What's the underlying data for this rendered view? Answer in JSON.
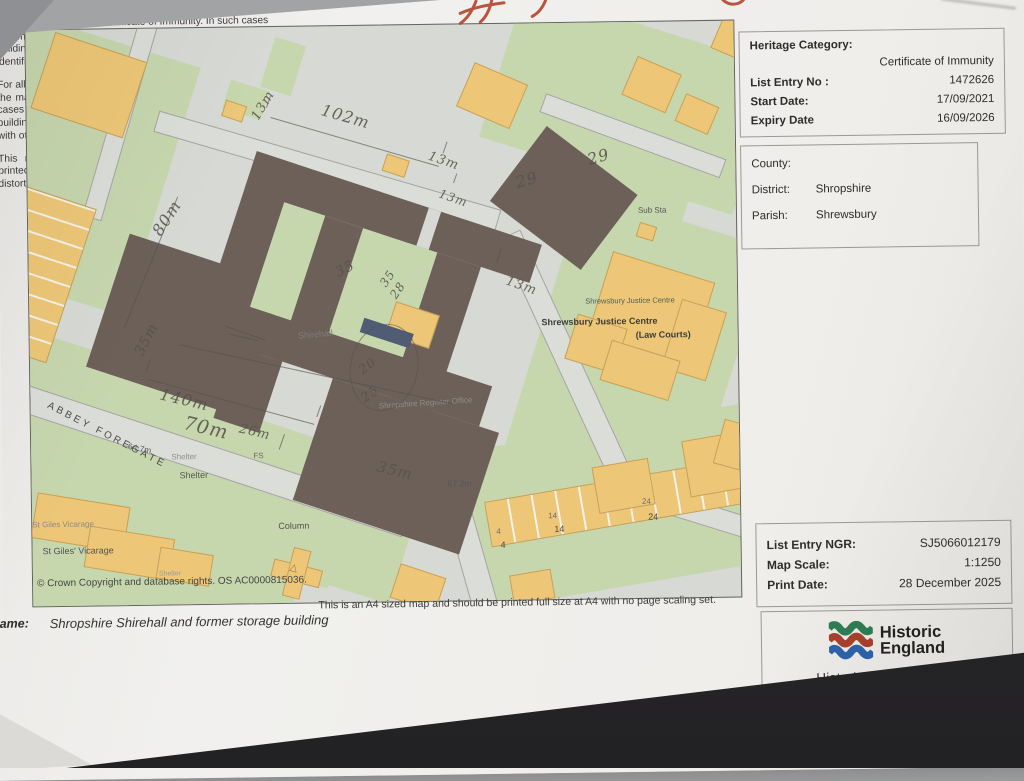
{
  "panel": {
    "heritage": {
      "title": "Heritage Category:",
      "category": "Certificate of Immunity",
      "rows": [
        {
          "label": "List Entry No :",
          "value": "1472626"
        },
        {
          "label": "Start Date:",
          "value": "17/09/2021"
        },
        {
          "label": "Expiry Date",
          "value": "16/09/2026"
        }
      ]
    },
    "location": {
      "rows": [
        {
          "label": "County:",
          "value": ""
        },
        {
          "label": "District:",
          "value": "Shropshire"
        },
        {
          "label": "Parish:",
          "value": "Shrewsbury"
        }
      ]
    },
    "paragraphs": [
      "For all Certificates of Immunity pre-dating 4 April 2011 maps do not form part of the Certificate of Immunity. In such cases the map here is generated from the description of the building within the Certificate and added later to aid identification of the principal listed building or buildings.",
      "For all Certificates of Immunity made on or after 4 April 2011 the map here does form part of the official record. In such cases the map is to aid identification of the principal listed building or buildings only and must be read in conjunction with other information in the record.",
      "This map has been delivered electronically and when printed may not be to scale and may be subject to distortions."
    ],
    "print_info": {
      "rows": [
        {
          "label": "List Entry NGR:",
          "value": "SJ5066012179"
        },
        {
          "label": "Map Scale:",
          "value": "1:1250"
        },
        {
          "label": "Print Date:",
          "value": "28 December 2025"
        }
      ]
    },
    "logo": {
      "line1": "Historic",
      "line2": "England",
      "url": "HistoricEngland.org.uk"
    }
  },
  "footer": {
    "print_note": "This is an A4 sized map and should be printed full size at A4 with no page scaling set.",
    "name_label": "Name:",
    "name_value": "Shropshire Shirehall and former storage building"
  },
  "map": {
    "copyright": "© Crown Copyright and database rights. OS AC0000815036.",
    "labels": [
      {
        "t": "ABBEY FOREGATE",
        "x": 20,
        "y": 370,
        "r": 28,
        "fs": 10,
        "c": "#4c4c4a",
        "ls": 3
      },
      {
        "t": "64.7m",
        "x": 98,
        "y": 412,
        "r": 12,
        "fs": 8.5,
        "c": "#5a5a58"
      },
      {
        "t": "Shelter",
        "x": 140,
        "y": 424,
        "r": 0,
        "fs": 8,
        "c": "#90908e"
      },
      {
        "t": "Shelter",
        "x": 148,
        "y": 442,
        "r": 0,
        "fs": 9,
        "c": "#575755"
      },
      {
        "t": "Shelter",
        "x": 126,
        "y": 542,
        "r": 0,
        "fs": 7,
        "c": "#9a9a98"
      },
      {
        "t": "St Giles Vicarage",
        "x": 0,
        "y": 490,
        "r": 0,
        "fs": 8,
        "c": "#8a8a88"
      },
      {
        "t": "St Giles' Vicarage",
        "x": 10,
        "y": 516,
        "r": 0,
        "fs": 9,
        "c": "#525250"
      },
      {
        "t": "Column",
        "x": 246,
        "y": 494,
        "r": 0,
        "fs": 9,
        "c": "#525250"
      },
      {
        "t": "FS",
        "x": 222,
        "y": 424,
        "r": 0,
        "fs": 8,
        "c": "#6a6a68"
      },
      {
        "t": "Sub Sta",
        "x": 610,
        "y": 184,
        "r": 0,
        "fs": 8,
        "c": "#565654"
      },
      {
        "t": "Shrewsbury Justice Centre",
        "x": 556,
        "y": 274,
        "r": 0,
        "fs": 7.5,
        "c": "#4e5e52"
      },
      {
        "t": "Shrewsbury Justice Centre",
        "x": 512,
        "y": 294,
        "r": 0,
        "fs": 9,
        "c": "#3c3c3a",
        "w": 600
      },
      {
        "t": "(Law Courts)",
        "x": 606,
        "y": 308,
        "r": 0,
        "fs": 9,
        "c": "#3c3c3a",
        "w": 600
      },
      {
        "t": "Shirehall",
        "x": 268,
        "y": 304,
        "r": -4,
        "fs": 9,
        "c": "#7e7e78"
      },
      {
        "t": "Shropshire Register Office",
        "x": 348,
        "y": 376,
        "r": -3,
        "fs": 8,
        "c": "#8e8e86"
      },
      {
        "t": "67.2m",
        "x": 416,
        "y": 454,
        "r": 0,
        "fs": 8.5,
        "c": "#565654"
      },
      {
        "t": "4",
        "x": 464,
        "y": 503,
        "r": 0,
        "fs": 8,
        "c": "#6e6e6c"
      },
      {
        "t": "14",
        "x": 516,
        "y": 488,
        "r": 0,
        "fs": 8,
        "c": "#6e6e6c"
      },
      {
        "t": "24",
        "x": 610,
        "y": 475,
        "r": 0,
        "fs": 8,
        "c": "#6e6e6c"
      },
      {
        "t": "4",
        "x": 468,
        "y": 516,
        "r": 0,
        "fs": 9,
        "c": "#494947"
      },
      {
        "t": "14",
        "x": 522,
        "y": 501,
        "r": 0,
        "fs": 9,
        "c": "#494947"
      },
      {
        "t": "24",
        "x": 616,
        "y": 490,
        "r": 0,
        "fs": 9,
        "c": "#494947"
      }
    ],
    "annotations": [
      {
        "t": "102m",
        "x": 298,
        "y": 74,
        "r": 17,
        "fs": 16
      },
      {
        "t": "13m",
        "x": 222,
        "y": 88,
        "r": -58,
        "fs": 13
      },
      {
        "t": "13m",
        "x": 404,
        "y": 124,
        "r": 20,
        "fs": 13
      },
      {
        "t": "13m",
        "x": 414,
        "y": 162,
        "r": 20,
        "fs": 12
      },
      {
        "t": "13m",
        "x": 480,
        "y": 250,
        "r": 20,
        "fs": 13
      },
      {
        "t": "29",
        "x": 486,
        "y": 150,
        "r": -15,
        "fs": 16
      },
      {
        "t": "29",
        "x": 558,
        "y": 128,
        "r": -15,
        "fs": 16
      },
      {
        "t": "80m",
        "x": 120,
        "y": 200,
        "r": -56,
        "fs": 16
      },
      {
        "t": "35",
        "x": 304,
        "y": 240,
        "r": -25,
        "fs": 14
      },
      {
        "t": "35",
        "x": 348,
        "y": 256,
        "r": -55,
        "fs": 12
      },
      {
        "t": "28",
        "x": 358,
        "y": 268,
        "r": -55,
        "fs": 12
      },
      {
        "t": "140m",
        "x": 132,
        "y": 356,
        "r": 14,
        "fs": 16
      },
      {
        "t": "70m",
        "x": 156,
        "y": 384,
        "r": 14,
        "fs": 19
      },
      {
        "t": "26m",
        "x": 210,
        "y": 394,
        "r": 14,
        "fs": 13
      },
      {
        "t": "35m",
        "x": 102,
        "y": 322,
        "r": -62,
        "fs": 14
      },
      {
        "t": "20",
        "x": 326,
        "y": 340,
        "r": -35,
        "fs": 13
      },
      {
        "t": "25",
        "x": 328,
        "y": 368,
        "r": -35,
        "fs": 13
      },
      {
        "t": "35m",
        "x": 348,
        "y": 432,
        "r": 14,
        "fs": 15
      }
    ]
  },
  "colors": {
    "map_background": "#d6d9d4",
    "vegetation_green": "#c6d6ad",
    "building_orange": "#edc777",
    "principal_building_brown": "#6c6058",
    "road_grey": "#dbddd8",
    "water_feature_blue": "#4f5c73",
    "pencil": "#57524c",
    "red_ink": "#b4432c",
    "logo_green": "#2e7d54",
    "logo_red": "#a8402c",
    "logo_blue": "#2e63a8",
    "desk_dark": "#28272a",
    "desk_grey": "#a2a3a5",
    "paper": "#efeeec"
  }
}
